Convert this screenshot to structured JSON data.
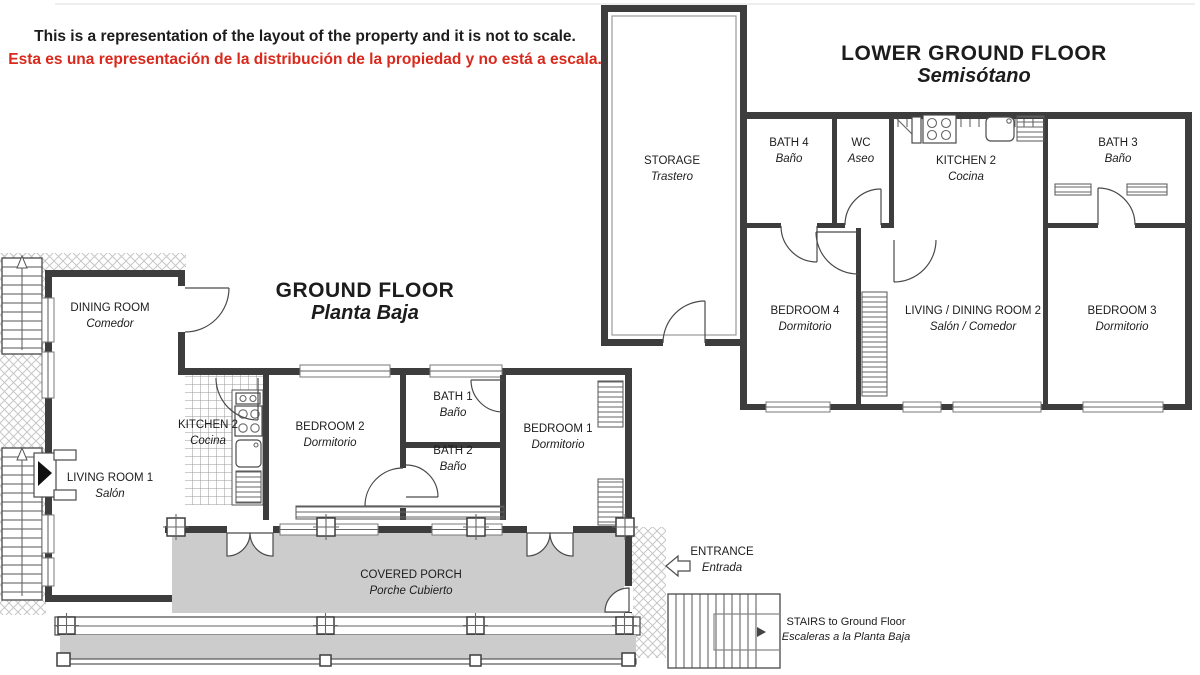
{
  "disclaimer": {
    "en": "This is a representation of the layout of the property and it is not to scale.",
    "es": "Esta es una representación de la distribución de la propiedad y no está a escala."
  },
  "floors": {
    "ground": {
      "title": "GROUND FLOOR",
      "subtitle": "Planta Baja",
      "rooms": {
        "dining_room": {
          "en": "DINING ROOM",
          "es": "Comedor"
        },
        "living_room_1": {
          "en": "LIVING ROOM 1",
          "es": "Salón"
        },
        "kitchen": {
          "en": "KITCHEN 2",
          "es": "Cocina"
        },
        "bedroom_2": {
          "en": "BEDROOM 2",
          "es": "Dormitorio"
        },
        "bath_1": {
          "en": "BATH 1",
          "es": "Baño"
        },
        "bath_2": {
          "en": "BATH 2",
          "es": "Baño"
        },
        "bedroom_1": {
          "en": "BEDROOM 1",
          "es": "Dormitorio"
        },
        "covered_porch": {
          "en": "COVERED PORCH",
          "es": "Porche Cubierto"
        }
      }
    },
    "lower_ground": {
      "title": "LOWER GROUND FLOOR",
      "subtitle": "Semisótano",
      "rooms": {
        "storage": {
          "en": "STORAGE",
          "es": "Trastero"
        },
        "bath_4": {
          "en": "BATH 4",
          "es": "Baño"
        },
        "wc": {
          "en": "WC",
          "es": "Aseo"
        },
        "kitchen_2": {
          "en": "KITCHEN 2",
          "es": "Cocina"
        },
        "bath_3": {
          "en": "BATH 3",
          "es": "Baño"
        },
        "bedroom_4": {
          "en": "BEDROOM 4",
          "es": "Dormitorio"
        },
        "living_dining_room_2": {
          "en": "LIVING / DINING ROOM 2",
          "es": "Salón / Comedor"
        },
        "bedroom_3": {
          "en": "BEDROOM 3",
          "es": "Dormitorio"
        }
      }
    }
  },
  "annotations": {
    "entrance": {
      "en": "ENTRANCE",
      "es": "Entrada"
    },
    "stairs_to_ground": {
      "en": "STAIRS to Ground Floor",
      "es": "Escaleras a la Planta Baja"
    }
  },
  "colors": {
    "disclaimer_red": "#d9291c",
    "porch_fill": "#cccccc",
    "wall": "#3d3d3d"
  }
}
